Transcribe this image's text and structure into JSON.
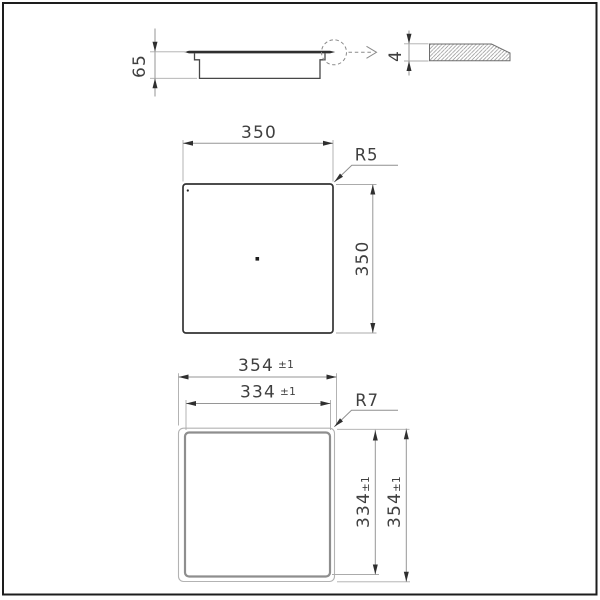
{
  "figure": {
    "side_view": {
      "height": "65"
    },
    "edge_detail": {
      "thickness": "4"
    },
    "top_view": {
      "width": "350",
      "depth": "350",
      "corner_radius": "R5"
    },
    "cutout_view": {
      "outer_width": "354",
      "outer_width_tolerance": "±1",
      "inner_width": "334",
      "inner_width_tolerance": "±1",
      "corner_radius": "R7",
      "inner_depth": "334",
      "inner_depth_tolerance": "±1",
      "outer_depth": "354",
      "outer_depth_tolerance": "±1"
    }
  }
}
